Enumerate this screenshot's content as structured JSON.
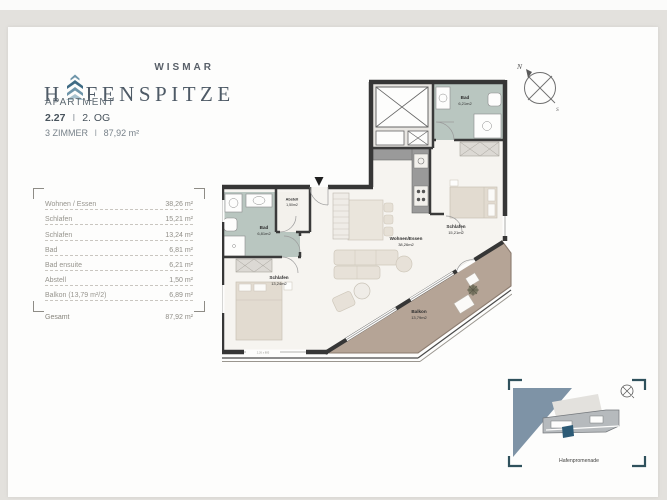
{
  "branding": {
    "city": "WISMAR",
    "logo_prefix": "H",
    "logo_suffix": "FENSPITZE"
  },
  "apartment": {
    "label": "APARTMENT",
    "number": "2.27",
    "separator": "I",
    "floor": "2. OG",
    "rooms": "3 ZIMMER",
    "total_area": "87,92 m²"
  },
  "area_table": {
    "rows": [
      {
        "label": "Wohnen / Essen",
        "value": "38,26 m²"
      },
      {
        "label": "Schlafen",
        "value": "15,21 m²"
      },
      {
        "label": "Schlafen",
        "value": "13,24 m²"
      },
      {
        "label": "Bad",
        "value": "6,81 m²"
      },
      {
        "label": "Bad ensuite",
        "value": "6,21 m²"
      },
      {
        "label": "Abstell",
        "value": "1,50 m²"
      },
      {
        "label": "Balkon (13,79 m²/2)",
        "value": "6,89 m²"
      }
    ],
    "total": {
      "label": "Gesamt",
      "value": "87,92 m²"
    }
  },
  "floorplan": {
    "rooms": {
      "bad_ensuite": {
        "name": "Bad",
        "area": "6,21m2"
      },
      "abstell": {
        "name": "Abstell",
        "area": "1,50m2"
      },
      "bad": {
        "name": "Bad",
        "area": "6,81m2"
      },
      "schlafen_right": {
        "name": "Schlafen",
        "area": "15,21m2"
      },
      "wohnen_essen": {
        "name": "Wohnen/Essen",
        "area": "38,26m2"
      },
      "schlafen_left": {
        "name": "Schlafen",
        "area": "13,24m2"
      },
      "balkon": {
        "name": "Balkon",
        "area": "13,79m2"
      }
    },
    "dimension_note": "2,26 x 885"
  },
  "compass": {
    "north": "N",
    "south": "S"
  },
  "minimap": {
    "street_label": "Hafenpromenade"
  },
  "colors": {
    "wall": "#363636",
    "bath_fill": "#b9c6c0",
    "balcony_fill": "#b5a496",
    "water": "#7e93a6",
    "unit_marker": "#2d5b76",
    "brand_dark": "#4e5a66",
    "chevron_dark": "#3f6b84",
    "chevron_mid": "#6e95a9",
    "chevron_light": "#a9c3cf"
  }
}
